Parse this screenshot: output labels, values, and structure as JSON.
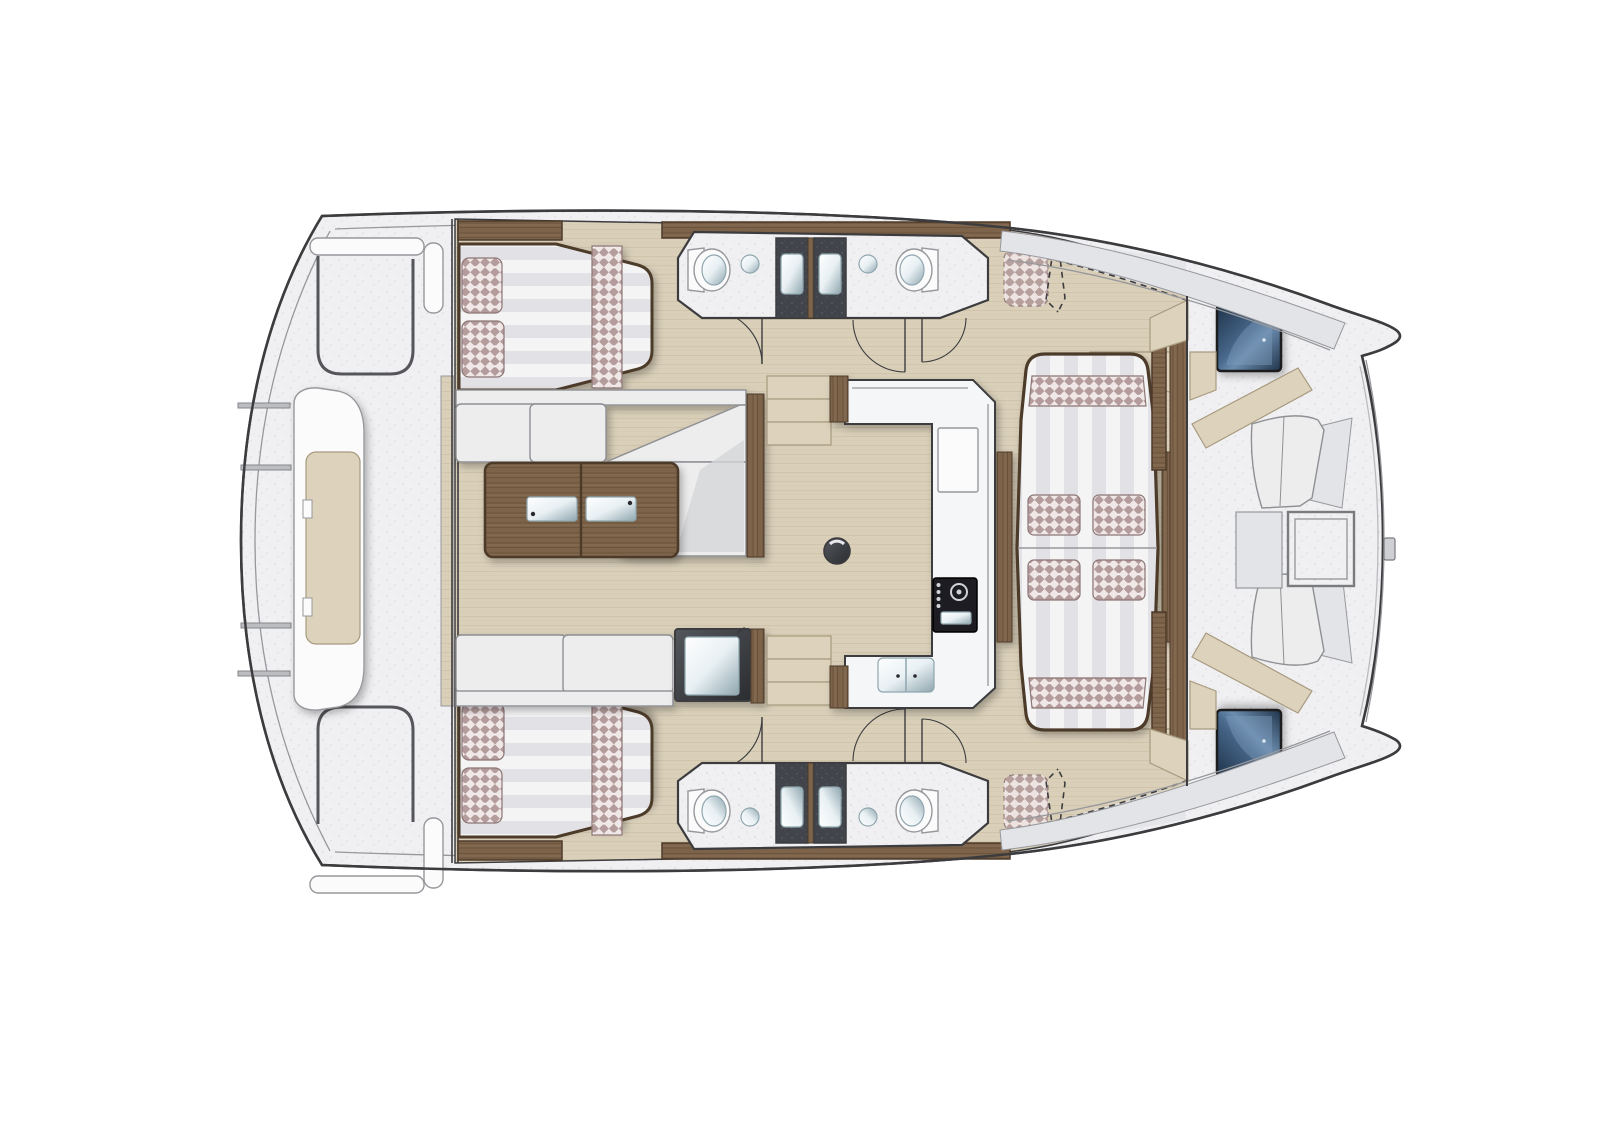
{
  "meta": {
    "view": "catamaran-deck-floorplan-top-view",
    "canvas": {
      "width": 1600,
      "height": 1131
    },
    "orientation": {
      "bow": "right",
      "stern": "left"
    }
  },
  "palette": {
    "bg": "#ffffff",
    "line": "#3c3c3f",
    "lineSoft": "#97989c",
    "deck": "#f0f0f2",
    "deckDot": "#b9babe",
    "bandGray": "#e3e4e7",
    "woodFloor": "#dad0ba",
    "woodLine": "#c3b699",
    "walnut": "#7d6349",
    "walnutLight": "#93785c",
    "walnutDark": "#4e3b2a",
    "cushion": "#ededee",
    "cushShade": "#d5d6d8",
    "cushionEdge": "#8f9094",
    "check1": "#b49c9c",
    "check2": "#f0e7e7",
    "checkEdge": "#8d7676",
    "stripeA": "#f4f4f5",
    "stripeB": "#e2e2e6",
    "beige": "#ddd2bb",
    "beigeEdge": "#a79a7f",
    "granite": "#41444a",
    "graniteDot": "#686d75",
    "steel": "#e8f0f3",
    "steelDark": "#8fa6af",
    "counter": "#f5f6f7",
    "white": "#fbfbfc",
    "hatchBlue": "#47678a",
    "hatchBlueDark": "#1f3349",
    "hatchFrame": "#1c1c1e"
  },
  "inventory": {
    "double_beds": 2,
    "bed_pillows": 4,
    "dashed_crew_berths": 2,
    "toilets": 4,
    "shower_stalls": 4,
    "round_washbasins": 4,
    "salon_sofas": 2,
    "coffee_tables": 1,
    "galley_stoves": 1,
    "galley_double_sinks": 1,
    "dinette_loose_cushions": 4,
    "bow_deck_hatches": 2,
    "bow_tables": 1,
    "aft_benches": 1,
    "door_swings": 6,
    "mast_foot": 1
  }
}
